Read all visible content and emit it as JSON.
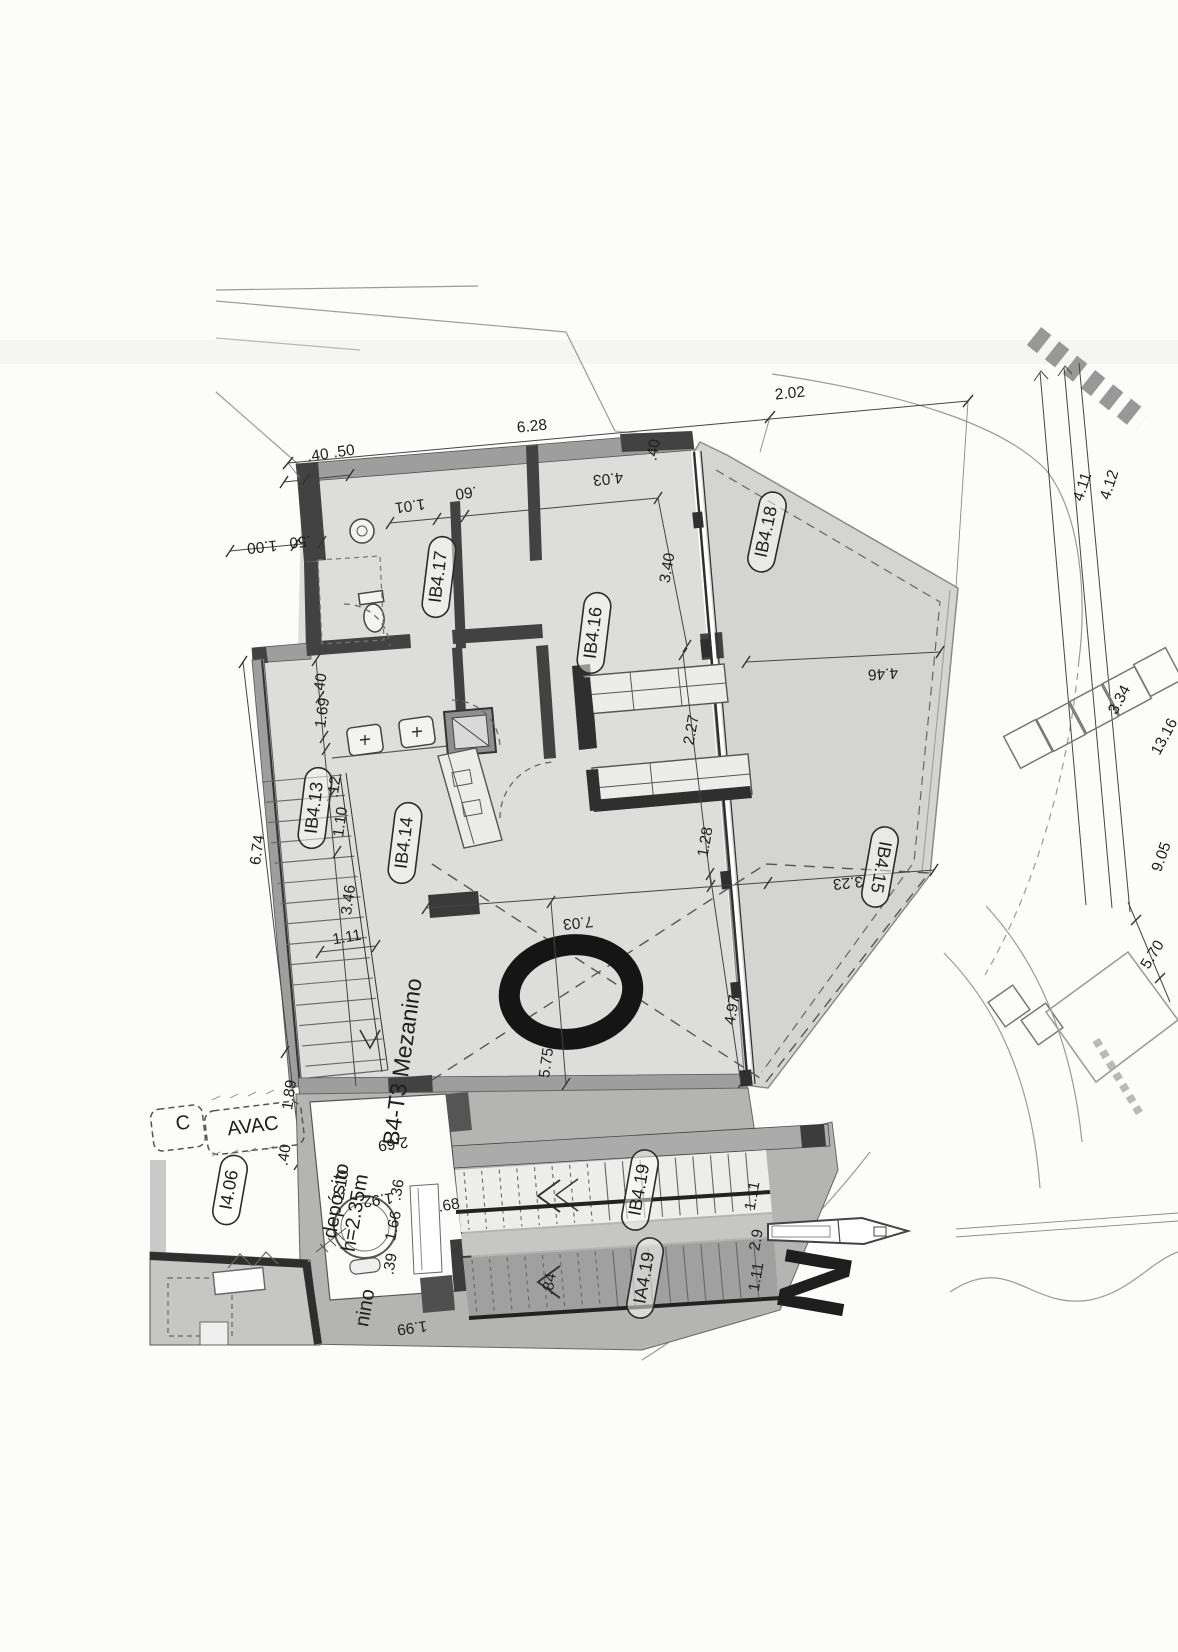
{
  "plan": {
    "unit_title": "B4-T3 Mezanino",
    "north_letter": "N",
    "room_labels": [
      {
        "t": "IB4.17",
        "x": 439,
        "y": 577,
        "rot": -83
      },
      {
        "t": "IB4.16",
        "x": 594,
        "y": 633,
        "rot": -83
      },
      {
        "t": "IB4.18",
        "x": 767,
        "y": 532,
        "rot": -78
      },
      {
        "t": "IB4.13",
        "x": 315,
        "y": 808,
        "rot": -83
      },
      {
        "t": "IB4.14",
        "x": 405,
        "y": 843,
        "rot": -83
      },
      {
        "t": "IB4.15",
        "x": 880,
        "y": 867,
        "rot": 100
      },
      {
        "t": "IB4.19",
        "x": 640,
        "y": 1190,
        "rot": -80
      },
      {
        "t": "IA4.19",
        "x": 645,
        "y": 1278,
        "rot": -80
      },
      {
        "t": "I4.06",
        "x": 230,
        "y": 1190,
        "rot": -80
      }
    ],
    "zone_labels": [
      {
        "t": "AVAC",
        "x": 253,
        "y": 1127,
        "rot": -7,
        "s": 20
      },
      {
        "t": "C",
        "x": 183,
        "y": 1124,
        "rot": -7,
        "s": 20
      },
      {
        "t": "depósito",
        "x": 337,
        "y": 1201,
        "rot": -80,
        "s": 16
      },
      {
        "t": "h=2.35m",
        "x": 356,
        "y": 1213,
        "rot": -80,
        "s": 16
      },
      {
        "t": "nino",
        "x": 366,
        "y": 1308,
        "rot": -80,
        "s": 20
      }
    ],
    "dimensions": [
      {
        "t": "6.28",
        "x": 532,
        "y": 427,
        "rot": -6,
        "s": 17
      },
      {
        "t": "2.02",
        "x": 790,
        "y": 394,
        "rot": -6,
        "s": 17
      },
      {
        "t": ".40",
        "x": 318,
        "y": 456,
        "rot": -8,
        "s": 14
      },
      {
        "t": ".50",
        "x": 344,
        "y": 452,
        "rot": -8,
        "s": 14
      },
      {
        "t": "1.00",
        "x": 262,
        "y": 546,
        "rot": 174
      },
      {
        "t": ".50",
        "x": 300,
        "y": 541,
        "rot": 174
      },
      {
        "t": "1.01",
        "x": 410,
        "y": 505,
        "rot": 172
      },
      {
        "t": ".60",
        "x": 466,
        "y": 492,
        "rot": 172
      },
      {
        "t": "4.03",
        "x": 608,
        "y": 478,
        "rot": 174
      },
      {
        "t": "3.40",
        "x": 668,
        "y": 568,
        "rot": -80
      },
      {
        "t": ".40",
        "x": 654,
        "y": 450,
        "rot": -80,
        "s": 13
      },
      {
        "t": ".40",
        "x": 321,
        "y": 684,
        "rot": -82,
        "s": 13
      },
      {
        "t": "1.69",
        "x": 323,
        "y": 713,
        "rot": -82
      },
      {
        "t": ".12",
        "x": 335,
        "y": 787,
        "rot": -82,
        "s": 14
      },
      {
        "t": "1.10",
        "x": 341,
        "y": 822,
        "rot": -82
      },
      {
        "t": "3.46",
        "x": 349,
        "y": 900,
        "rot": -82
      },
      {
        "t": "6.74",
        "x": 258,
        "y": 850,
        "rot": -82
      },
      {
        "t": "1.11",
        "x": 347,
        "y": 938,
        "rot": -10
      },
      {
        "t": "2.27",
        "x": 692,
        "y": 730,
        "rot": -80
      },
      {
        "t": "1.28",
        "x": 706,
        "y": 842,
        "rot": -80
      },
      {
        "t": "7.03",
        "x": 578,
        "y": 922,
        "rot": 174
      },
      {
        "t": "5.75",
        "x": 547,
        "y": 1063,
        "rot": -82
      },
      {
        "t": "4.97",
        "x": 733,
        "y": 1010,
        "rot": -80
      },
      {
        "t": "3.23",
        "x": 848,
        "y": 882,
        "rot": 174
      },
      {
        "t": "4.46",
        "x": 883,
        "y": 673,
        "rot": 176
      },
      {
        "t": "1.89",
        "x": 290,
        "y": 1095,
        "rot": -82
      },
      {
        "t": "2.69",
        "x": 393,
        "y": 1143,
        "rot": 172
      },
      {
        "t": "2.10",
        "x": 342,
        "y": 1185,
        "rot": -80
      },
      {
        "t": ".40",
        "x": 285,
        "y": 1155,
        "rot": -80,
        "s": 13
      },
      {
        "t": ".36",
        "x": 398,
        "y": 1190,
        "rot": -80,
        "s": 14
      },
      {
        "t": "1.92",
        "x": 378,
        "y": 1199,
        "rot": 172,
        "s": 14
      },
      {
        "t": "1.66",
        "x": 394,
        "y": 1226,
        "rot": -78,
        "s": 14
      },
      {
        "t": ".39",
        "x": 391,
        "y": 1264,
        "rot": -80,
        "s": 14
      },
      {
        "t": ".68",
        "x": 449,
        "y": 1206,
        "rot": -10,
        "s": 14
      },
      {
        "t": ".84",
        "x": 550,
        "y": 1284,
        "rot": -80
      },
      {
        "t": "1.11",
        "x": 753,
        "y": 1196,
        "rot": -80
      },
      {
        "t": "2.9",
        "x": 757,
        "y": 1240,
        "rot": -80
      },
      {
        "t": "1.11",
        "x": 757,
        "y": 1277,
        "rot": -80
      },
      {
        "t": "1.99",
        "x": 412,
        "y": 1327,
        "rot": 172
      },
      {
        "t": "4.11",
        "x": 1083,
        "y": 487,
        "rot": -72
      },
      {
        "t": "4.12",
        "x": 1110,
        "y": 485,
        "rot": -72
      },
      {
        "t": "3.34",
        "x": 1120,
        "y": 700,
        "rot": -62
      },
      {
        "t": "13.16",
        "x": 1165,
        "y": 737,
        "rot": -62
      },
      {
        "t": "9.05",
        "x": 1162,
        "y": 857,
        "rot": -70
      },
      {
        "t": "5.70",
        "x": 1153,
        "y": 955,
        "rot": -58
      }
    ],
    "colors": {
      "paper": "#fcfcfb",
      "floor_fill": "#dddddc",
      "terrace_fill": "#d4d4d3",
      "lower_floor_fill": "#b4b4b3",
      "wall_dark": "#3f3f3f",
      "ink": "#1e1e1e"
    }
  }
}
